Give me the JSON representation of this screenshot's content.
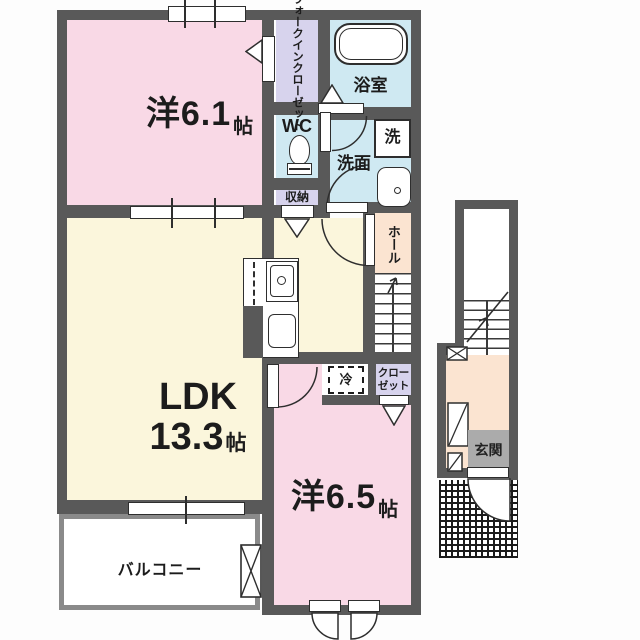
{
  "plan": {
    "bedroom1": {
      "label": "洋6.1",
      "unit": "帖"
    },
    "bedroom2": {
      "label": "洋6.5",
      "unit": "帖"
    },
    "ldk": {
      "label": "LDK",
      "size": "13.3",
      "unit": "帖"
    },
    "walk_in_closet": {
      "line1": "ウォークイン",
      "line2": "クローゼット"
    },
    "bathroom": {
      "label": "浴室"
    },
    "toilet": {
      "label": "WC"
    },
    "washroom": {
      "label": "洗面"
    },
    "washer": {
      "label": "洗"
    },
    "storage": {
      "label": "収納"
    },
    "hall": {
      "label": "ホール"
    },
    "refrigerator": {
      "label": "冷"
    },
    "closet": {
      "line1": "クロー",
      "line2": "ゼット"
    },
    "balcony": {
      "label": "バルコニー"
    },
    "entrance": {
      "label": "玄関"
    }
  },
  "colors": {
    "wall": "#595959",
    "room_pink": "#f9d9e6",
    "room_cream": "#fbf6dc",
    "room_blue": "#cfe9f2",
    "room_lavender": "#d7d3ed",
    "room_peach": "#fbe4d1",
    "entrance_label_bg": "#ababab",
    "line": "#2e2e2e"
  }
}
